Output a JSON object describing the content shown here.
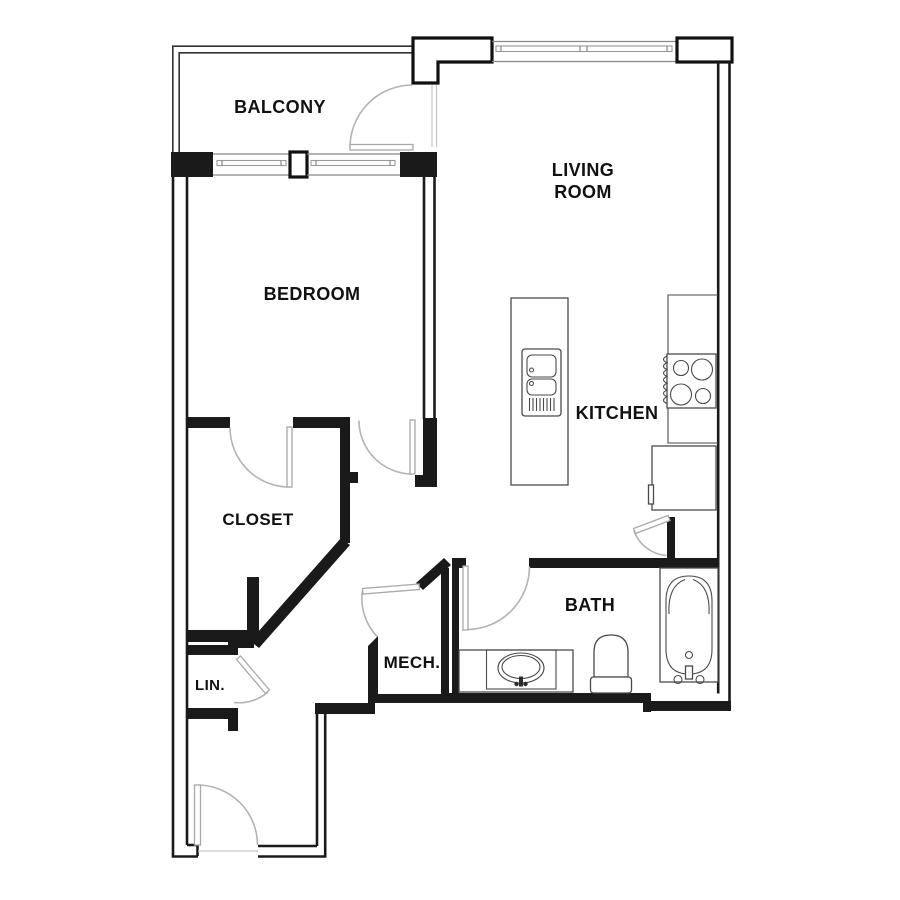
{
  "plan": {
    "rooms": [
      {
        "id": "balcony",
        "label": "BALCONY"
      },
      {
        "id": "living-room",
        "label_lines": [
          "LIVING",
          "ROOM"
        ]
      },
      {
        "id": "bedroom",
        "label": "BEDROOM"
      },
      {
        "id": "closet",
        "label": "CLOSET"
      },
      {
        "id": "kitchen",
        "label": "KITCHEN"
      },
      {
        "id": "bath",
        "label": "BATH"
      },
      {
        "id": "mech",
        "label": "MECH."
      },
      {
        "id": "linen",
        "label": "LIN."
      }
    ],
    "fixtures": [
      "kitchen-island",
      "island-sink",
      "cooktop",
      "refrigerator",
      "bathtub",
      "toilet",
      "vanity-sink"
    ],
    "doors": [
      "balcony-door",
      "closet-door",
      "bedroom-door",
      "bath-door",
      "kitchen-hall-door",
      "mech-door",
      "linen-door",
      "entry-door"
    ],
    "windows": [
      "living-room-window",
      "balcony-window-left",
      "balcony-window-right"
    ],
    "colors": {
      "wall": "#1a1a1a",
      "door_swing": "#b3b3b3",
      "fixture": "#4a4a4a",
      "background": "#ffffff",
      "label": "#111111"
    }
  }
}
